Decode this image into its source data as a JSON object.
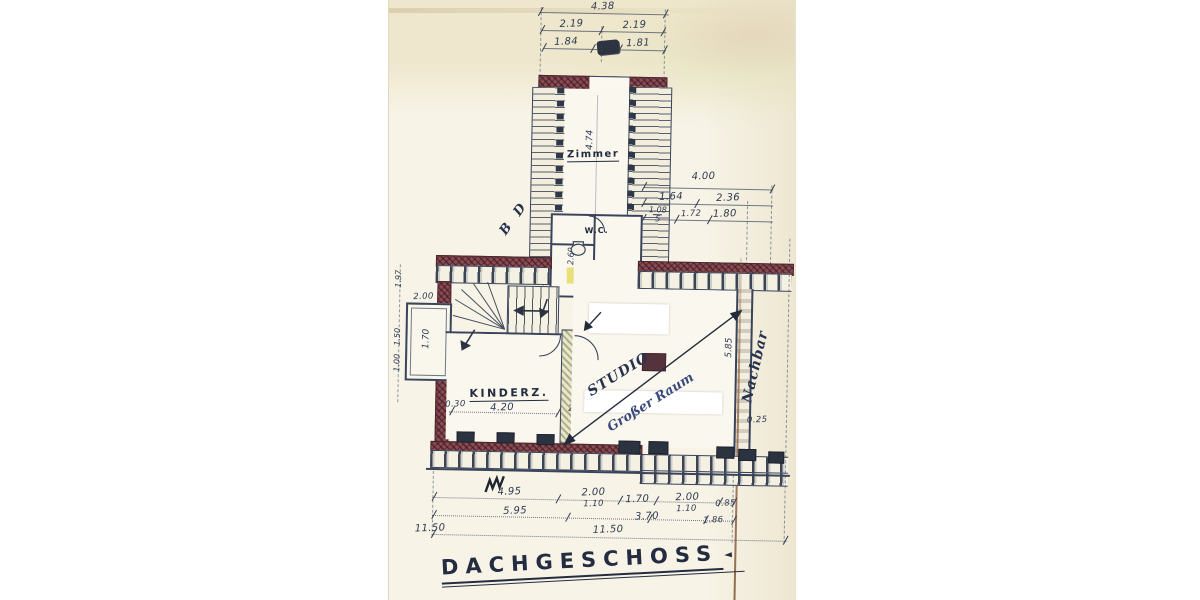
{
  "document": {
    "title": "DACHGESCHOSS",
    "title_flourish": "◄"
  },
  "rooms": {
    "zimmer": "Zimmer",
    "wc": "W.C.",
    "kinderz": "KINDERZ.",
    "studio": "STUDIO",
    "studio_sub": "Großer Raum"
  },
  "annotations": {
    "neighbor": "Nachbar",
    "letters": "B D"
  },
  "dims": {
    "top": {
      "total": "4.38",
      "left_half": "2.19",
      "right_half": "2.19",
      "sub_left": "1.84",
      "sub_right": "1.81"
    },
    "right": {
      "total": "4.00",
      "a": "1.64",
      "b": "2.36",
      "c": "1.08",
      "c_sub": "5",
      "d": "1.72",
      "e": "1.80"
    },
    "left": {
      "a": "1.97",
      "b": "2.00",
      "bay": "1.70",
      "c": "1.50",
      "d": "1.00"
    },
    "interior": {
      "zimmer_length": "4.74",
      "wc_width": "2.60",
      "kinderz_width": "4.20",
      "wall_a": "0.30",
      "wall_b": "25",
      "kinderz_height": "4.86",
      "studio_height": "5.85",
      "wall_c": "0.25"
    },
    "bottom": {
      "a": "4.95",
      "b": "2.00",
      "b_sub": "1.10",
      "c": "1.70",
      "d": "2.00",
      "d_sub": "1.10",
      "e": "0.85",
      "e_sub": "1.86",
      "f": "5.95",
      "g": "3.70",
      "total": "11.50",
      "total_2": "11.50"
    }
  },
  "colors": {
    "ink_blue": "#39435a",
    "masonry_red": "#8d4a52",
    "paper_cream": "#f7f3e6",
    "crease_brown": "#9a6b49",
    "highlight_yellow": "#e6de6e",
    "pen_blue": "#27324e"
  }
}
